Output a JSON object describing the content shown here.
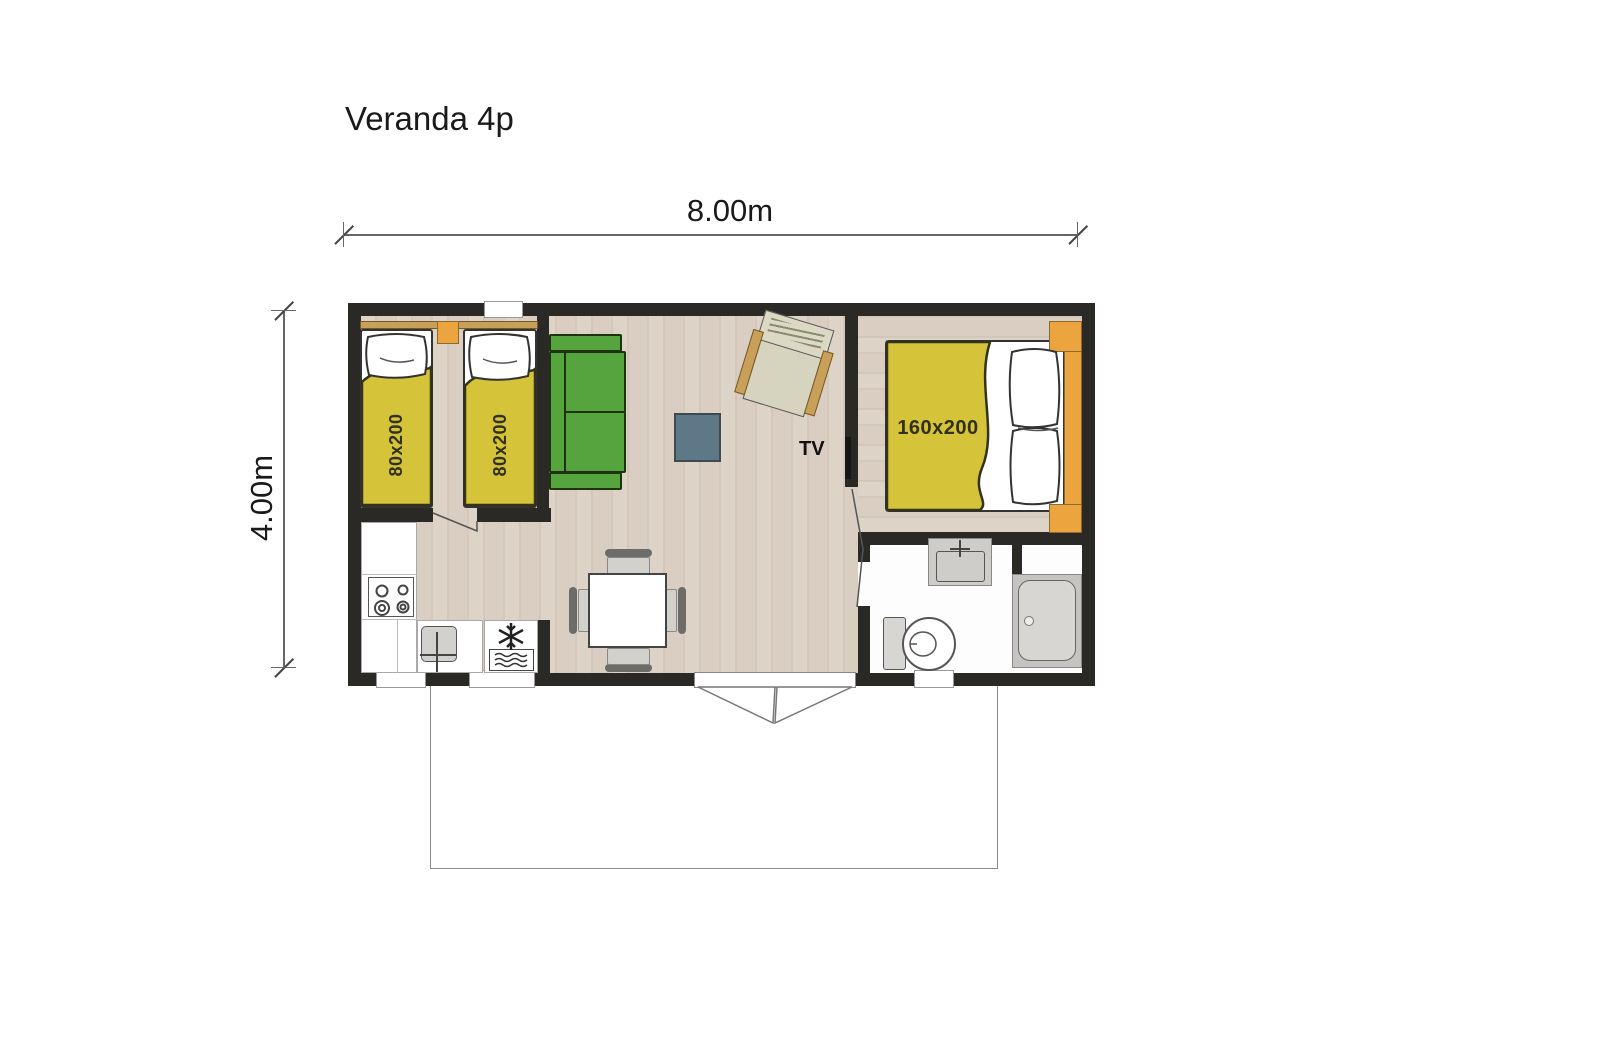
{
  "title": "Veranda 4p",
  "dimensions": {
    "width_label": "8.00m",
    "height_label": "4.00m"
  },
  "labels": {
    "bed_single_1": "80x200",
    "bed_single_2": "80x200",
    "bed_double": "160x200",
    "tv": "TV"
  },
  "colors": {
    "wall": "#2b2925",
    "floor_light": "#ddd3c7",
    "floor_dark": "#d2c7b8",
    "bathroom_floor": "#fdfdfd",
    "bed_yellow": "#d5c43a",
    "sofa_green": "#56a43d",
    "wood_orange": "#eca43f",
    "wood_tan": "#c9a05a",
    "coffee_table_blue": "#5e7887",
    "dim_line": "#666666",
    "text": "#1a1a1a"
  }
}
